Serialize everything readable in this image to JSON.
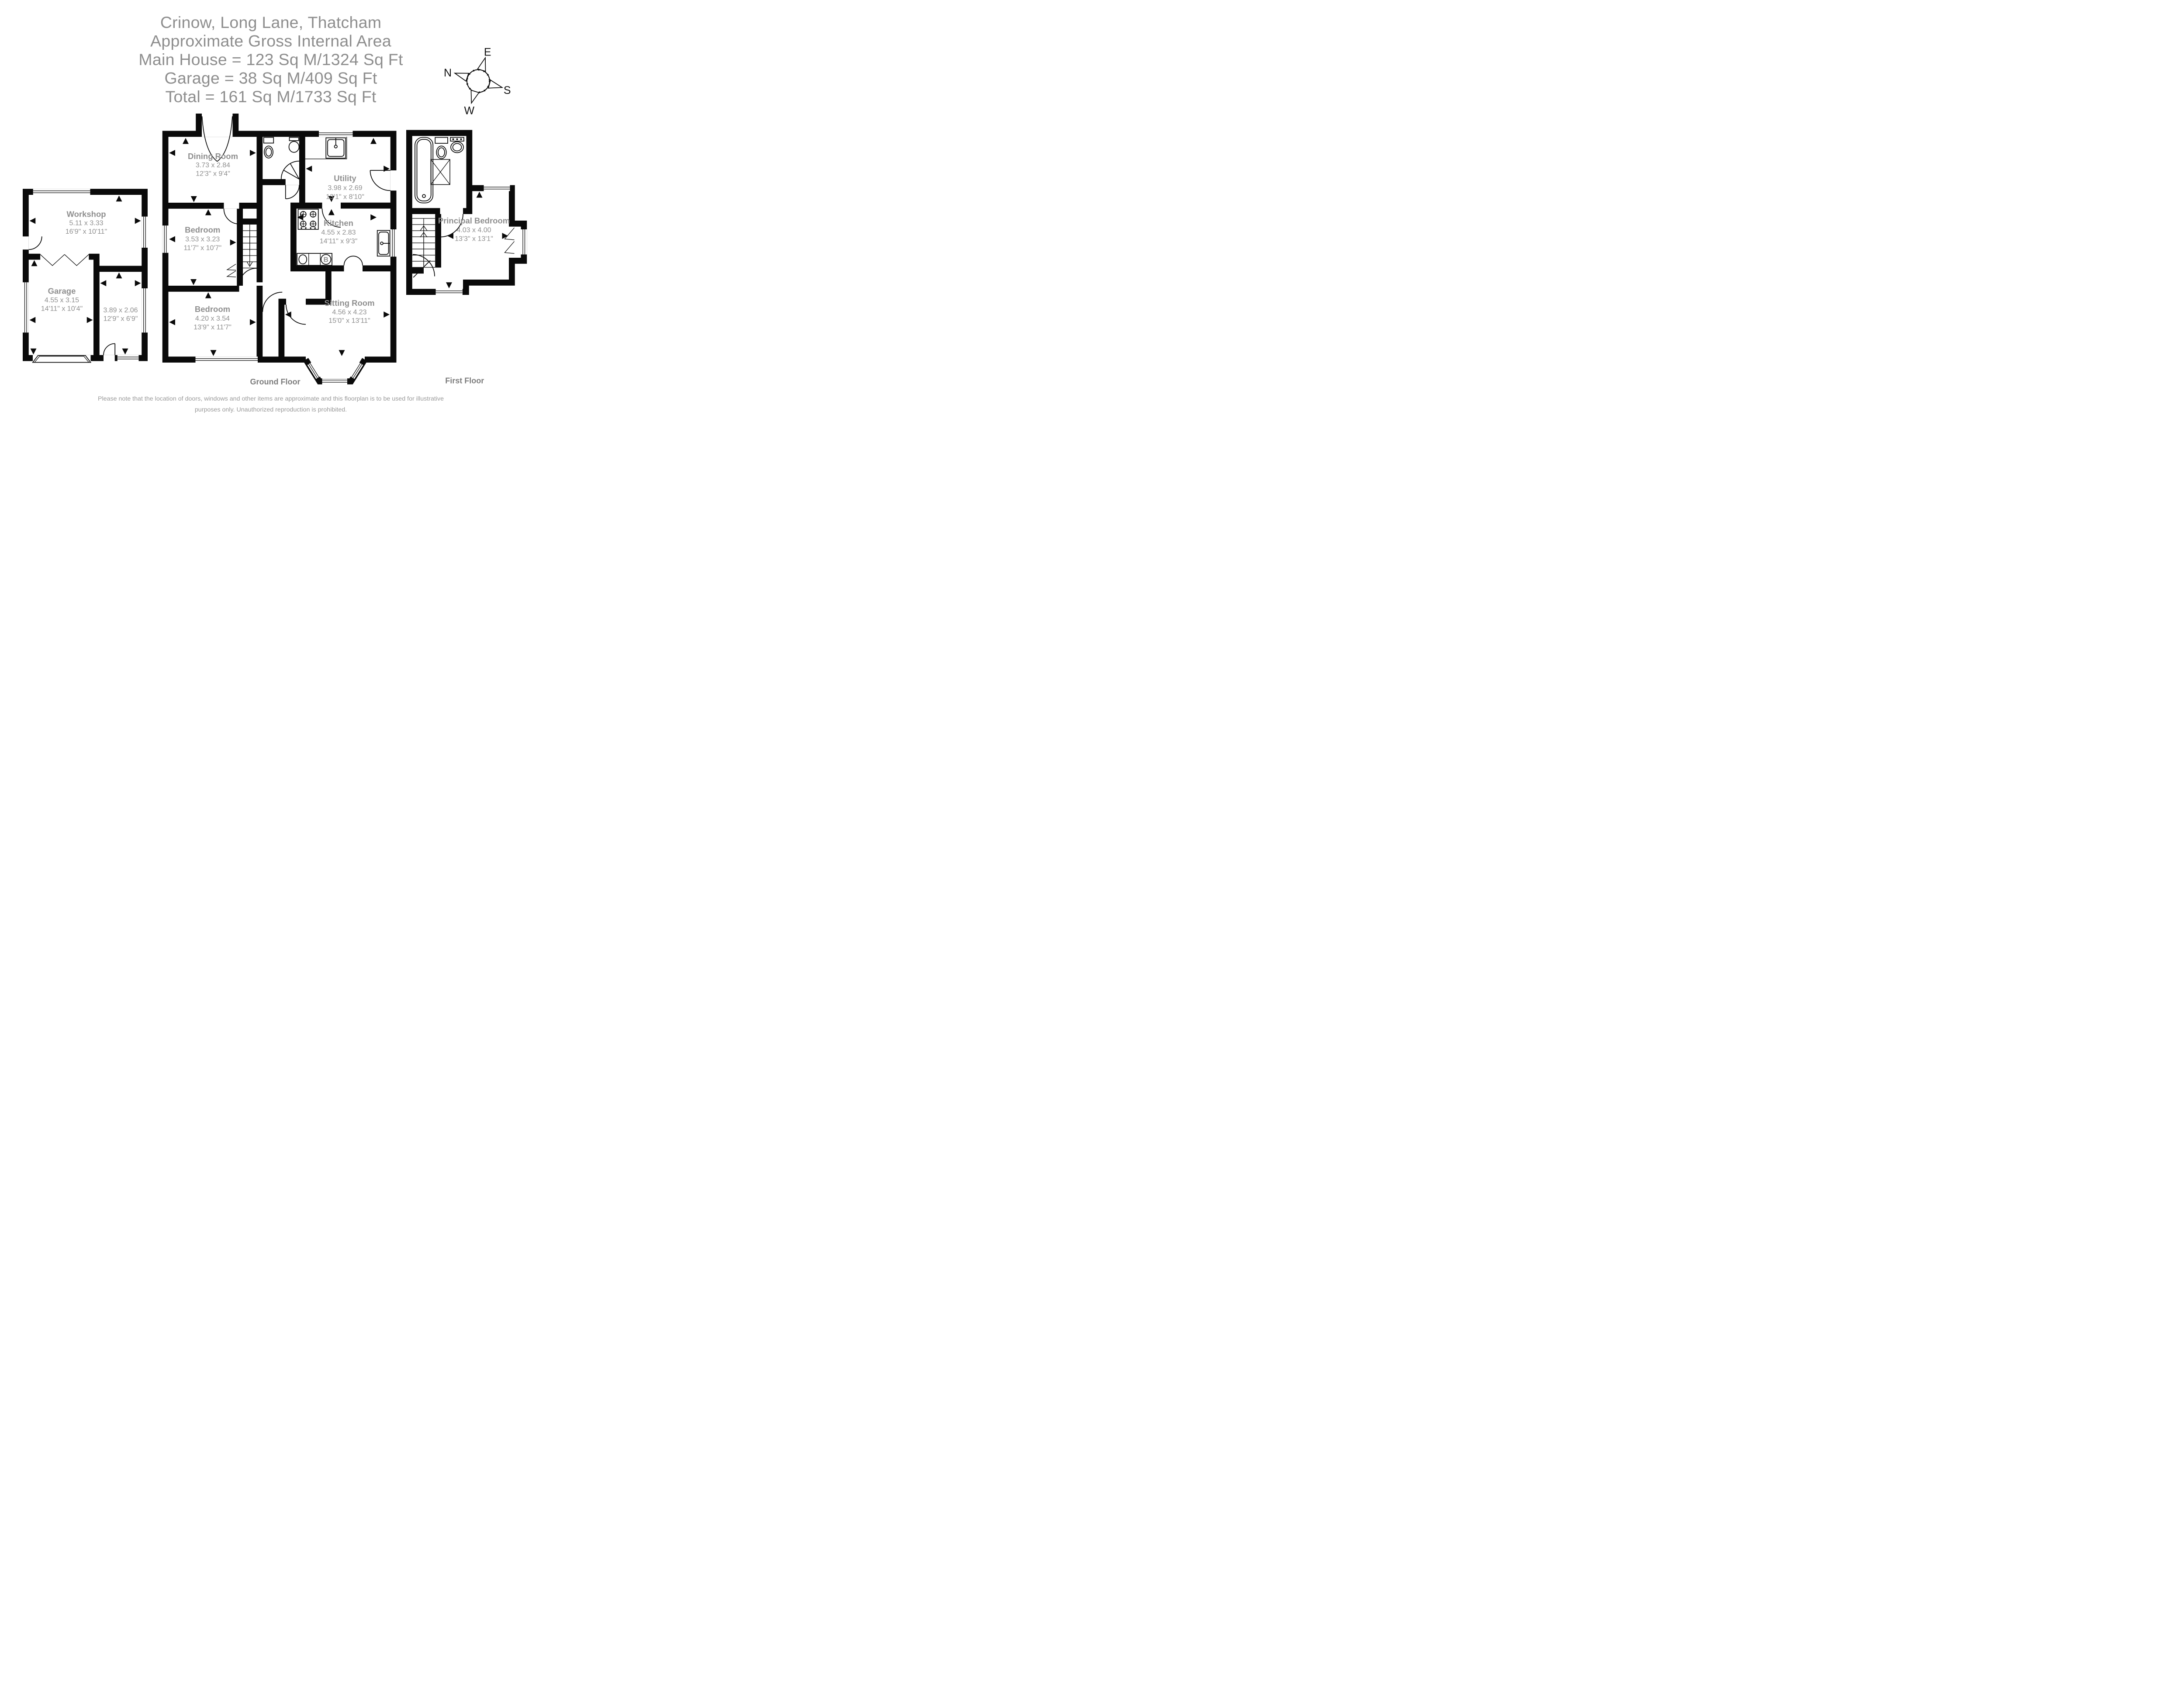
{
  "title": {
    "address": "Crinow, Long Lane, Thatcham",
    "subtitle": "Approximate Gross Internal Area",
    "main_house": "Main House = 123 Sq M/1324 Sq Ft",
    "garage": "Garage = 38 Sq M/409 Sq Ft",
    "total": "Total = 161 Sq M/1733 Sq Ft"
  },
  "compass": {
    "north": "N",
    "east": "E",
    "south": "S",
    "west": "W"
  },
  "floors": {
    "ground": "Ground Floor",
    "first": "First Floor"
  },
  "rooms": {
    "workshop": {
      "name": "Workshop",
      "metric": "5.11 x 3.33",
      "imperial": "16'9\" x 10'11\""
    },
    "garage": {
      "name": "Garage",
      "metric": "4.55 x 3.15",
      "imperial": "14'11\" x 10'4\""
    },
    "store": {
      "metric": "3.89 x 2.06",
      "imperial": "12'9\" x 6'9\""
    },
    "dining_room": {
      "name": "Dining Room",
      "metric": "3.73 x 2.84",
      "imperial": "12'3\" x 9'4\""
    },
    "utility": {
      "name": "Utility",
      "metric": "3.98 x 2.69",
      "imperial": "13'1\" x 8'10\""
    },
    "kitchen": {
      "name": "Kitchen",
      "metric": "4.55 x 2.83",
      "imperial": "14'11\" x 9'3\""
    },
    "bedroom_middle": {
      "name": "Bedroom",
      "metric": "3.53 x 3.23",
      "imperial": "11'7\" x 10'7\""
    },
    "bedroom_front": {
      "name": "Bedroom",
      "metric": "4.20 x 3.54",
      "imperial": "13'9\" x 11'7\""
    },
    "sitting_room": {
      "name": "Sitting Room",
      "metric": "4.56 x 4.23",
      "imperial": "15'0\" x 13'11\""
    },
    "principal_bedroom": {
      "name": "Principal Bedroom",
      "metric": "4.03 x 4.00",
      "imperial": "13'3\" x 13'1\""
    }
  },
  "labels": {
    "boiler": "B"
  },
  "disclaimer": {
    "line1": "Please note that the location of doors, windows and other items are approximate and this floorplan is to be used for illustrative",
    "line2": "purposes only. Unauthorized reproduction is prohibited."
  }
}
